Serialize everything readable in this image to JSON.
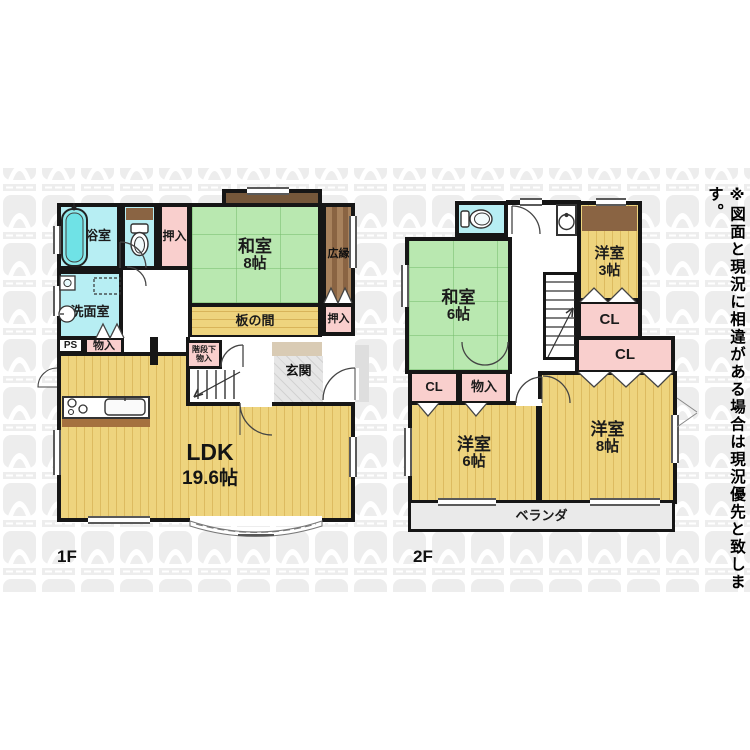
{
  "note": "※図面と現況に相違がある場合は現況優先と致します。",
  "floor1": {
    "label": "1F",
    "bath": "浴室",
    "washroom": "洗面室",
    "oshiire_top": "押入",
    "washitsu_name": "和室",
    "washitsu_size": "8帖",
    "hiroen": "広縁",
    "itanoma": "板の間",
    "oshiire_right": "押入",
    "ps": "PS",
    "monoire": "物入",
    "understairs_line1": "階段下",
    "understairs_line2": "物入",
    "genkan": "玄関",
    "ldk_name": "LDK",
    "ldk_size": "19.6帖"
  },
  "floor2": {
    "label": "2F",
    "washitsu_name": "和室",
    "washitsu_size": "6帖",
    "yoshitsu3_name": "洋室",
    "yoshitsu3_size": "3帖",
    "cl1": "CL",
    "cl2": "CL",
    "cl3": "CL",
    "monoire": "物入",
    "yoshitsu6_name": "洋室",
    "yoshitsu6_size": "6帖",
    "yoshitsu8_name": "洋室",
    "yoshitsu8_size": "8帖",
    "veranda": "ベランダ"
  },
  "colors": {
    "wall": "#161616",
    "tatami_green": "#b9e8b0",
    "wood_floor_yellow": "#eed47e",
    "closet_pink": "#f9cfcd",
    "wet_area_cyan": "#b7eef3",
    "hiroen_brown": "#8a6443",
    "balcony_gray": "#eaeaea",
    "watermark_gray": "#ededed"
  }
}
